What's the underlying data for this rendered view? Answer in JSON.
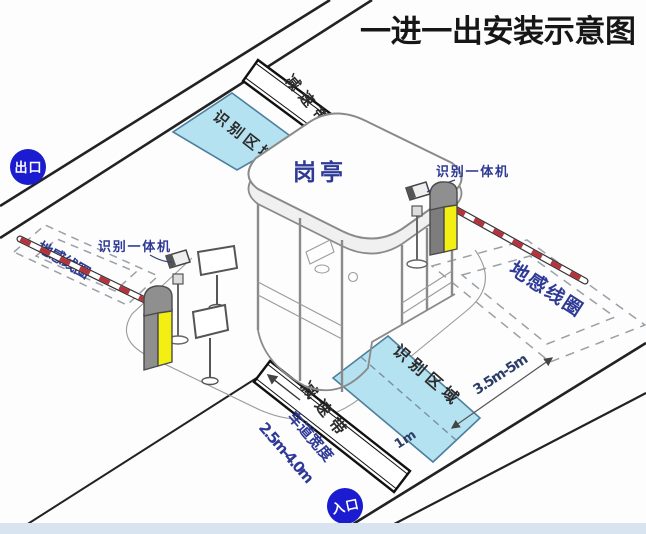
{
  "title": "一进一出安装示意图",
  "badges": {
    "exit": "出口",
    "entry": "入口"
  },
  "booth": {
    "label": "岗亭"
  },
  "labels": {
    "recognition_area": "识别区域",
    "speed_bump": "减速带",
    "ground_loop": "地感线圈",
    "camera_unit": "识别一体机",
    "lane_width_title": "车道宽度",
    "lane_width_value": "2.5m-4.0m",
    "loop_distance": "3.5m-5m",
    "area_offset": "1m"
  },
  "colors": {
    "badge_blue": "#1b1bd0",
    "area_fill": "#b5e2f0",
    "area_border": "#4d7f9e",
    "machine_yellow": "#f4ef12",
    "machine_gray": "#8f8f8f",
    "arm_red": "#b6323c",
    "label_navy": "#2e3a96",
    "dash_gray": "#9aa0a6",
    "bottom_strip": "#d8e4f0"
  }
}
